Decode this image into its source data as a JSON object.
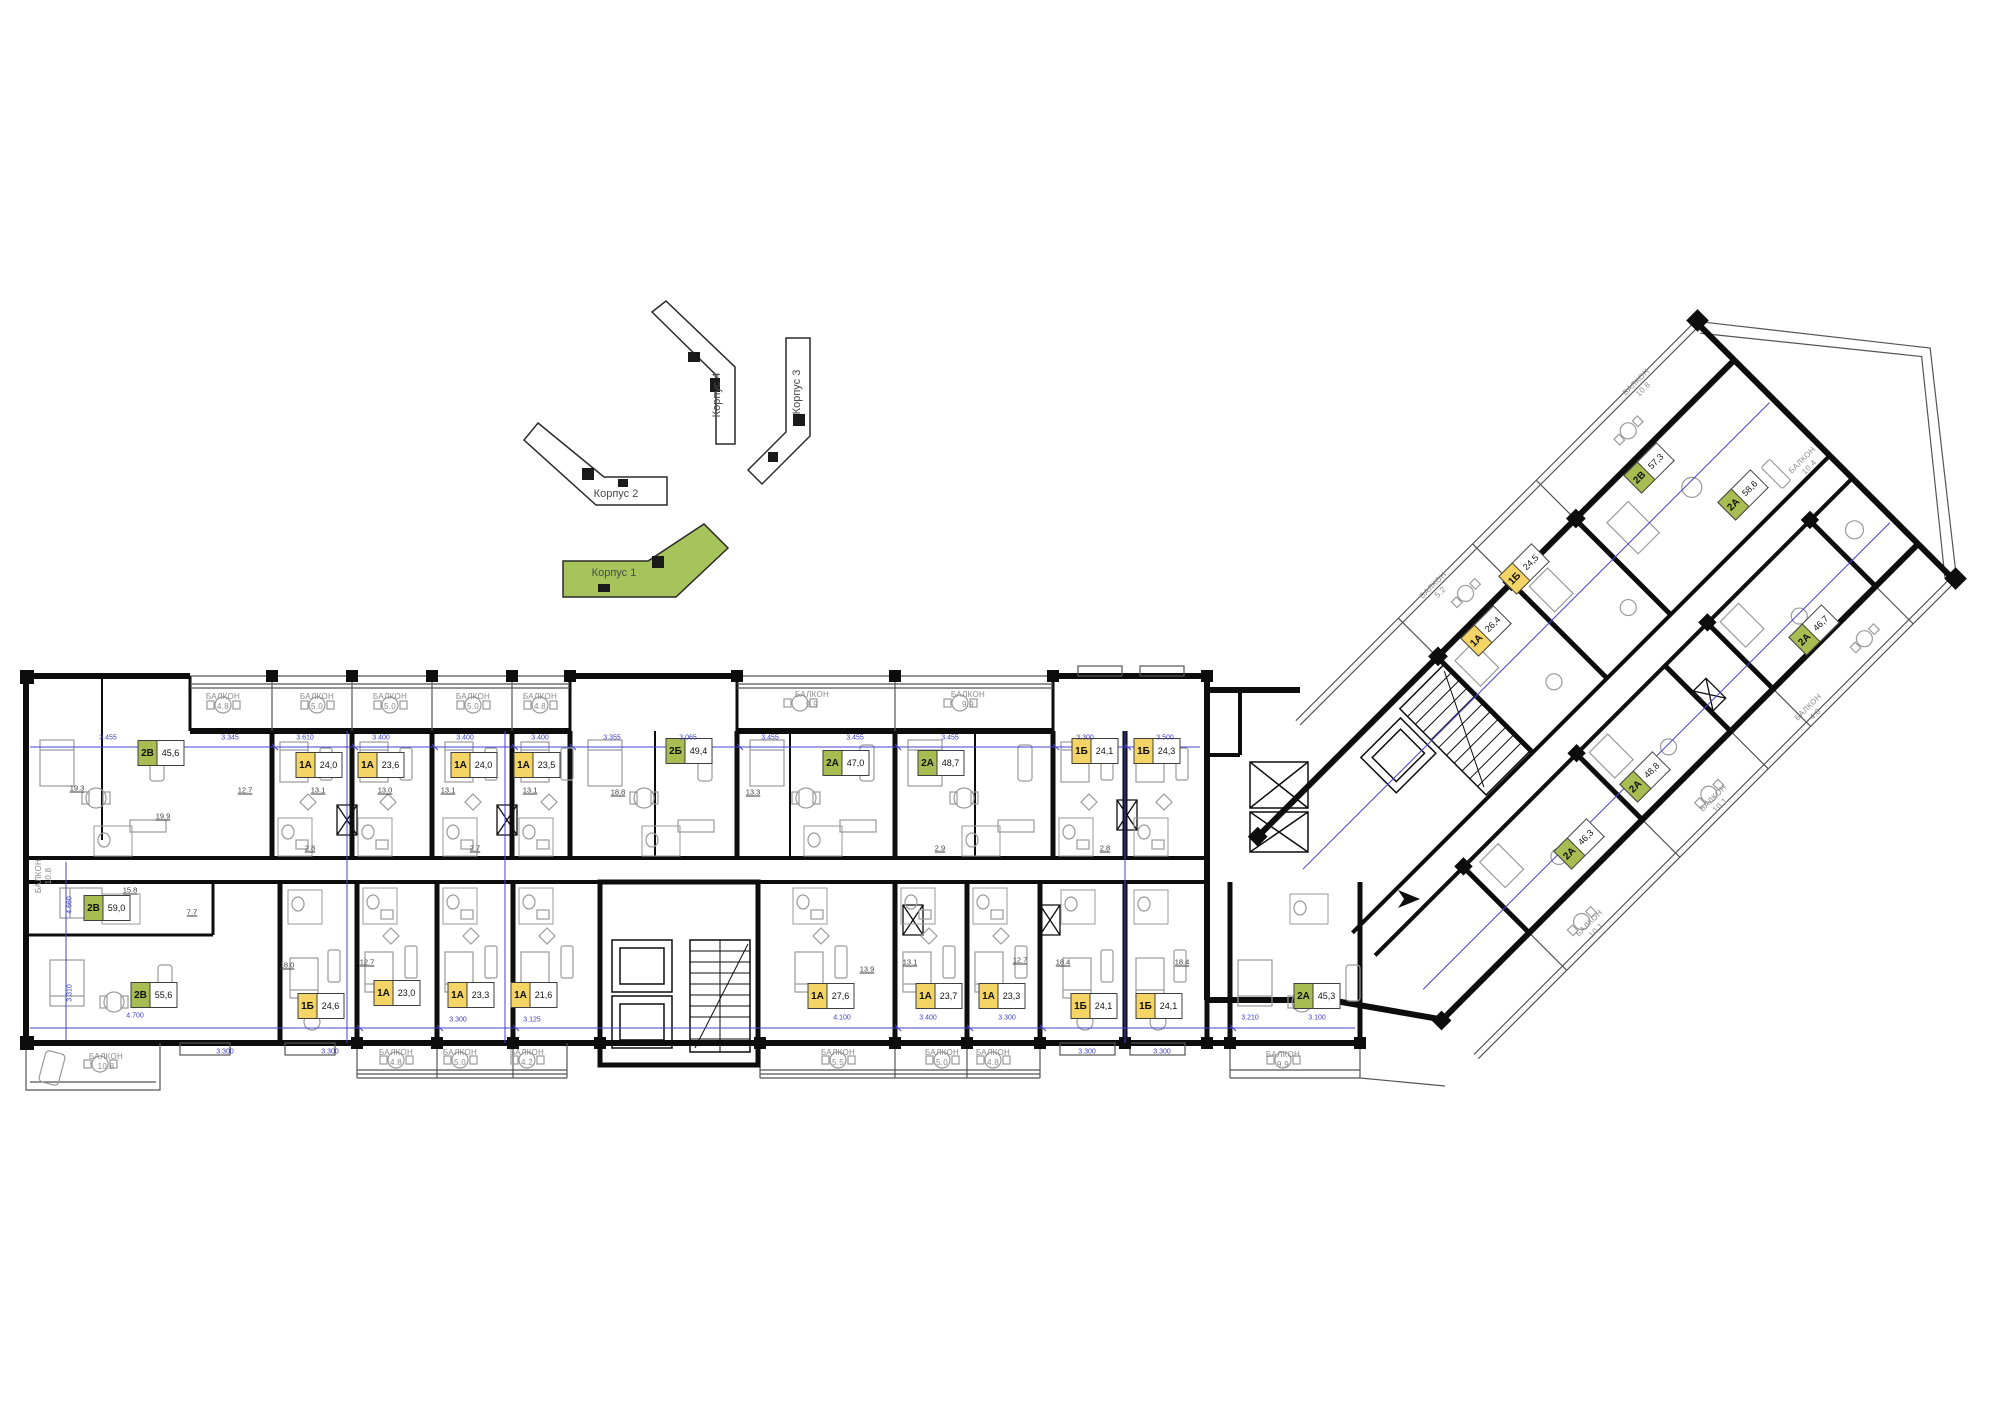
{
  "palette": {
    "one_room_badge": "#f3d465",
    "two_room_badge": "#a8bc52",
    "site_highlight": "#a7c45c",
    "dimension_blue": "#3c3ccd",
    "wall_black": "#0d0d0d",
    "balcony_text_gray": "#8a8a8a"
  },
  "site_plan": {
    "buildings": [
      {
        "id": "korpus-4",
        "label": "Корпус 4",
        "x": 717,
        "y": 395,
        "rot": -90,
        "highlighted": false
      },
      {
        "id": "korpus-3",
        "label": "Корпус 3",
        "x": 797,
        "y": 392,
        "rot": -90,
        "highlighted": false
      },
      {
        "id": "korpus-2",
        "label": "Корпус 2",
        "x": 616,
        "y": 494,
        "rot": 0,
        "highlighted": false
      },
      {
        "id": "korpus-1",
        "label": "Корпус 1",
        "x": 614,
        "y": 573,
        "rot": 0,
        "highlighted": true
      }
    ]
  },
  "apartments": {
    "top_row": [
      {
        "type": "2В",
        "area": "45,6",
        "cat": "two",
        "x": 161,
        "y": 753
      },
      {
        "type": "1А",
        "area": "24,0",
        "cat": "one",
        "x": 319,
        "y": 765
      },
      {
        "type": "1А",
        "area": "23,6",
        "cat": "one",
        "x": 381,
        "y": 765
      },
      {
        "type": "1А",
        "area": "24,0",
        "cat": "one",
        "x": 474,
        "y": 765
      },
      {
        "type": "1А",
        "area": "23,5",
        "cat": "one",
        "x": 537,
        "y": 765
      },
      {
        "type": "2Б",
        "area": "49,4",
        "cat": "two",
        "x": 689,
        "y": 751
      },
      {
        "type": "2А",
        "area": "47,0",
        "cat": "two",
        "x": 846,
        "y": 763
      },
      {
        "type": "2А",
        "area": "48,7",
        "cat": "two",
        "x": 941,
        "y": 763
      },
      {
        "type": "1Б",
        "area": "24,1",
        "cat": "one",
        "x": 1095,
        "y": 751
      },
      {
        "type": "1Б",
        "area": "24,3",
        "cat": "one",
        "x": 1157,
        "y": 751
      }
    ],
    "bottom_row": [
      {
        "type": "2В",
        "area": "59,0",
        "cat": "two",
        "x": 107,
        "y": 908
      },
      {
        "type": "2В",
        "area": "55,6",
        "cat": "two",
        "x": 154,
        "y": 995
      },
      {
        "type": "1Б",
        "area": "24,6",
        "cat": "one",
        "x": 321,
        "y": 1006
      },
      {
        "type": "1А",
        "area": "23,0",
        "cat": "one",
        "x": 397,
        "y": 993
      },
      {
        "type": "1А",
        "area": "23,3",
        "cat": "one",
        "x": 471,
        "y": 995
      },
      {
        "type": "1А",
        "area": "21,6",
        "cat": "one",
        "x": 534,
        "y": 995
      },
      {
        "type": "1А",
        "area": "27,6",
        "cat": "one",
        "x": 831,
        "y": 996
      },
      {
        "type": "1А",
        "area": "23,7",
        "cat": "one",
        "x": 939,
        "y": 996
      },
      {
        "type": "1А",
        "area": "23,3",
        "cat": "one",
        "x": 1002,
        "y": 996
      },
      {
        "type": "1Б",
        "area": "24,1",
        "cat": "one",
        "x": 1094,
        "y": 1006
      },
      {
        "type": "1Б",
        "area": "24,1",
        "cat": "one",
        "x": 1159,
        "y": 1006
      },
      {
        "type": "2А",
        "area": "45,3",
        "cat": "two",
        "x": 1317,
        "y": 996
      }
    ],
    "wing": [
      {
        "type": "2В",
        "area": "57,3",
        "cat": "two",
        "x": 1649,
        "y": 468,
        "rot": -45
      },
      {
        "type": "2А",
        "area": "58,6",
        "cat": "two",
        "x": 1743,
        "y": 495,
        "rot": -45
      },
      {
        "type": "1Б",
        "area": "24,5",
        "cat": "one",
        "x": 1524,
        "y": 569,
        "rot": -45
      },
      {
        "type": "1А",
        "area": "26,4",
        "cat": "one",
        "x": 1486,
        "y": 631,
        "rot": -45
      },
      {
        "type": "2А",
        "area": "46,7",
        "cat": "two",
        "x": 1814,
        "y": 630,
        "rot": -45
      },
      {
        "type": "2А",
        "area": "48,8",
        "cat": "two",
        "x": 1645,
        "y": 777,
        "rot": -45
      },
      {
        "type": "2А",
        "area": "46,3",
        "cat": "two",
        "x": 1579,
        "y": 844,
        "rot": -45
      }
    ]
  },
  "balconies": {
    "top_row": [
      {
        "name": "БАЛКОН",
        "area": "4.8",
        "x": 223,
        "y": 702
      },
      {
        "name": "БАЛКОН",
        "area": "5.0",
        "x": 317,
        "y": 702
      },
      {
        "name": "БАЛКОН",
        "area": "5.0",
        "x": 390,
        "y": 702
      },
      {
        "name": "БАЛКОН",
        "area": "5.0",
        "x": 473,
        "y": 702
      },
      {
        "name": "БАЛКОН",
        "area": "4.8",
        "x": 540,
        "y": 702
      },
      {
        "name": "БАЛКОН",
        "area": "9.9",
        "x": 812,
        "y": 700
      },
      {
        "name": "БАЛКОН",
        "area": "9.9",
        "x": 968,
        "y": 700
      }
    ],
    "bottom_row": [
      {
        "name": "БАЛКОН",
        "area": "10.8",
        "x": 106,
        "y": 1062
      },
      {
        "name": "БАЛКОН",
        "area": "4.8",
        "x": 396,
        "y": 1058
      },
      {
        "name": "БАЛКОН",
        "area": "5.0",
        "x": 460,
        "y": 1058
      },
      {
        "name": "БАЛКОН",
        "area": "4.2",
        "x": 527,
        "y": 1058
      },
      {
        "name": "БАЛКОН",
        "area": "5.5",
        "x": 838,
        "y": 1058
      },
      {
        "name": "БАЛКОН",
        "area": "5.0",
        "x": 942,
        "y": 1058
      },
      {
        "name": "БАЛКОН",
        "area": "4.8",
        "x": 993,
        "y": 1058
      },
      {
        "name": "БАЛКОН",
        "area": "9.9",
        "x": 1283,
        "y": 1060
      }
    ],
    "left_edge": [
      {
        "name": "БАЛКОН",
        "area": "10.8",
        "x": 44,
        "y": 876,
        "rot": -90
      }
    ],
    "wing": [
      {
        "name": "БАЛКОН",
        "area": "10.8",
        "x": 1640,
        "y": 386,
        "rot": -45
      },
      {
        "name": "БАЛКОН",
        "area": "10.4",
        "x": 1806,
        "y": 464,
        "rot": -45
      },
      {
        "name": "БАЛКОН",
        "area": "5.2",
        "x": 1437,
        "y": 589,
        "rot": -45
      },
      {
        "name": "БАЛКОН",
        "area": "4.8",
        "x": 1812,
        "y": 711,
        "rot": -45
      },
      {
        "name": "БАЛКОН",
        "area": "10.1",
        "x": 1717,
        "y": 802,
        "rot": -45
      },
      {
        "name": "БАЛКОН",
        "area": "10.1",
        "x": 1593,
        "y": 927,
        "rot": -45
      }
    ]
  },
  "dimensions": {
    "top": [
      {
        "v": "3.455",
        "x": 108,
        "y": 738
      },
      {
        "v": "3.345",
        "x": 230,
        "y": 738
      },
      {
        "v": "3.610",
        "x": 305,
        "y": 738
      },
      {
        "v": "3.400",
        "x": 381,
        "y": 738
      },
      {
        "v": "3.400",
        "x": 465,
        "y": 738
      },
      {
        "v": "3.400",
        "x": 540,
        "y": 738
      },
      {
        "v": "3.355",
        "x": 612,
        "y": 738
      },
      {
        "v": "3.065",
        "x": 688,
        "y": 738
      },
      {
        "v": "3.455",
        "x": 770,
        "y": 738
      },
      {
        "v": "3.455",
        "x": 855,
        "y": 738
      },
      {
        "v": "3.455",
        "x": 950,
        "y": 738
      },
      {
        "v": "3.300",
        "x": 1085,
        "y": 738
      },
      {
        "v": "3.500",
        "x": 1165,
        "y": 738
      }
    ],
    "bottom": [
      {
        "v": "4.700",
        "x": 135,
        "y": 1016
      },
      {
        "v": "3.300",
        "x": 225,
        "y": 1052
      },
      {
        "v": "3.300",
        "x": 330,
        "y": 1052
      },
      {
        "v": "3.300",
        "x": 458,
        "y": 1020
      },
      {
        "v": "3.125",
        "x": 532,
        "y": 1020
      },
      {
        "v": "4.100",
        "x": 842,
        "y": 1018
      },
      {
        "v": "3.400",
        "x": 928,
        "y": 1018
      },
      {
        "v": "3.300",
        "x": 1007,
        "y": 1018
      },
      {
        "v": "3.300",
        "x": 1087,
        "y": 1052
      },
      {
        "v": "3.300",
        "x": 1162,
        "y": 1052
      },
      {
        "v": "3.210",
        "x": 1250,
        "y": 1018
      },
      {
        "v": "3.100",
        "x": 1317,
        "y": 1018
      }
    ],
    "left": [
      {
        "v": "4.660",
        "x": 70,
        "y": 905,
        "rot": -90
      },
      {
        "v": "3.310",
        "x": 70,
        "y": 993,
        "rot": -90
      }
    ]
  },
  "room_areas": [
    {
      "v": "19.3",
      "x": 77,
      "y": 788
    },
    {
      "v": "19.9",
      "x": 163,
      "y": 816
    },
    {
      "v": "12.7",
      "x": 245,
      "y": 790
    },
    {
      "v": "13.1",
      "x": 318,
      "y": 790
    },
    {
      "v": "13.0",
      "x": 385,
      "y": 790
    },
    {
      "v": "13.1",
      "x": 448,
      "y": 790
    },
    {
      "v": "13.1",
      "x": 530,
      "y": 790
    },
    {
      "v": "18.8",
      "x": 618,
      "y": 792
    },
    {
      "v": "13.3",
      "x": 753,
      "y": 792
    },
    {
      "v": "15.8",
      "x": 130,
      "y": 890
    },
    {
      "v": "7.7",
      "x": 192,
      "y": 912
    },
    {
      "v": "18.0",
      "x": 287,
      "y": 965
    },
    {
      "v": "12.7",
      "x": 367,
      "y": 962
    },
    {
      "v": "13.9",
      "x": 867,
      "y": 969
    },
    {
      "v": "13.1",
      "x": 910,
      "y": 962
    },
    {
      "v": "12.7",
      "x": 1020,
      "y": 960
    },
    {
      "v": "18.4",
      "x": 1063,
      "y": 962
    },
    {
      "v": "18.4",
      "x": 1182,
      "y": 962
    },
    {
      "v": "2.8",
      "x": 310,
      "y": 848
    },
    {
      "v": "2.7",
      "x": 475,
      "y": 848
    },
    {
      "v": "2.9",
      "x": 940,
      "y": 848
    },
    {
      "v": "2.8",
      "x": 1105,
      "y": 848
    }
  ]
}
